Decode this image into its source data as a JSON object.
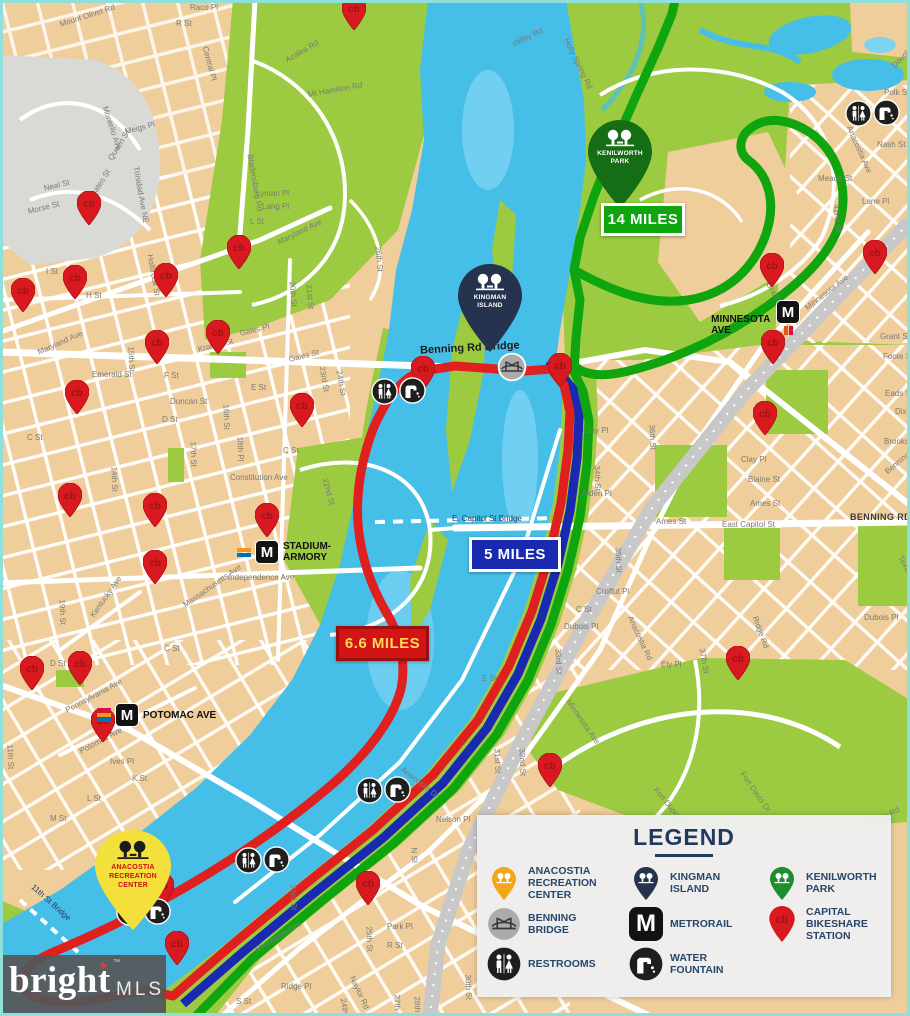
{
  "map": {
    "mile_markers": [
      {
        "id": "green",
        "text": "14 MILES",
        "x": 601,
        "y": 203,
        "w": 78,
        "h": 27,
        "bg": "#0FA50F",
        "border": "#FFFFFF",
        "color": "#FFFFFF"
      },
      {
        "id": "blue",
        "text": "5 MILES",
        "x": 469,
        "y": 537,
        "w": 86,
        "h": 29,
        "bg": "#1A2AB0",
        "border": "#FFFFFF",
        "color": "#FFFFFF"
      },
      {
        "id": "red",
        "text": "6.6 MILES",
        "x": 336,
        "y": 626,
        "w": 87,
        "h": 29,
        "bg": "#D31414",
        "border": "#9C0F0F",
        "color": "#FFD957"
      }
    ],
    "bridge_labels": [
      {
        "text": "Benning Rd Bridge",
        "x": 420,
        "y": 342,
        "r": -3,
        "small": false
      },
      {
        "text": "E. Capitol St Bridge",
        "x": 452,
        "y": 514,
        "r": 0,
        "small": true
      },
      {
        "text": "11th St Bridge",
        "x": 26,
        "y": 898,
        "r": 42,
        "small": true
      }
    ],
    "landmark_pins": [
      {
        "id": "kenilworth",
        "lines": "KENILWORTH\nPARK",
        "x": 620,
        "y": 208,
        "color": "#156E15",
        "tree_color": "#FFFFFF",
        "text_color": "#FFFFFF"
      },
      {
        "id": "kingman",
        "lines": "KINGMAN\nISLAND",
        "x": 490,
        "y": 352,
        "color": "#26334F",
        "tree_color": "#FFFFFF",
        "text_color": "#FFFFFF"
      },
      {
        "id": "recreation",
        "lines": "ANACOSTIA\nRECREATION\nCENTER",
        "x": 133,
        "y": 930,
        "color": "#F4E03A",
        "tree_color": "#1B1B1B",
        "text_color": "#CC1111"
      }
    ],
    "metro_logo": "M",
    "metro_stations": [
      {
        "name": "MINNESOTA AVE",
        "x": 787,
        "y": 324,
        "side": "vert",
        "stripes": [
          "#E6541F",
          "#D31245"
        ]
      },
      {
        "name": "STADIUM-\nARMORY",
        "x": 264,
        "y": 551,
        "side": "right",
        "stripes": [
          "#F7941D",
          "#0072BC"
        ]
      },
      {
        "name": "POTOMAC AVE",
        "x": 124,
        "y": 714,
        "side": "right",
        "stripes": [
          "#D31245",
          "#F7941D",
          "#0072BC"
        ]
      }
    ],
    "bikeshare_pins": [
      {
        "x": 354,
        "y": 13
      },
      {
        "x": 89,
        "y": 208
      },
      {
        "x": 239,
        "y": 252
      },
      {
        "x": 166,
        "y": 280
      },
      {
        "x": 75,
        "y": 282
      },
      {
        "x": 23,
        "y": 295
      },
      {
        "x": 157,
        "y": 347
      },
      {
        "x": 218,
        "y": 337
      },
      {
        "x": 77,
        "y": 397
      },
      {
        "x": 302,
        "y": 410
      },
      {
        "x": 423,
        "y": 373
      },
      {
        "x": 772,
        "y": 270
      },
      {
        "x": 875,
        "y": 257
      },
      {
        "x": 773,
        "y": 347
      },
      {
        "x": 765,
        "y": 418
      },
      {
        "x": 560,
        "y": 370
      },
      {
        "x": 70,
        "y": 500
      },
      {
        "x": 155,
        "y": 510
      },
      {
        "x": 267,
        "y": 520
      },
      {
        "x": 155,
        "y": 567
      },
      {
        "x": 32,
        "y": 673
      },
      {
        "x": 80,
        "y": 668
      },
      {
        "x": 103,
        "y": 725
      },
      {
        "x": 162,
        "y": 890
      },
      {
        "x": 177,
        "y": 948
      },
      {
        "x": 368,
        "y": 888
      },
      {
        "x": 738,
        "y": 663
      },
      {
        "x": 550,
        "y": 770
      }
    ],
    "amenity_pairs": [
      {
        "x": 398,
        "y": 391
      },
      {
        "x": 872,
        "y": 113
      },
      {
        "x": 383,
        "y": 790
      },
      {
        "x": 262,
        "y": 860
      },
      {
        "x": 143,
        "y": 912
      }
    ],
    "bridge_icons": [
      {
        "x": 512,
        "y": 367
      }
    ],
    "street_labels": [
      {
        "t": "Mount Olivet Rd",
        "x": 60,
        "y": 20,
        "r": -18
      },
      {
        "t": "Central Pl",
        "x": 205,
        "y": 42,
        "r": 75
      },
      {
        "t": "Raco Pl",
        "x": 190,
        "y": 3,
        "r": 0
      },
      {
        "t": "R St",
        "x": 176,
        "y": 19,
        "r": 0
      },
      {
        "t": "Bladensburg Rd",
        "x": 250,
        "y": 150,
        "r": 80
      },
      {
        "t": "Azalea Rd",
        "x": 286,
        "y": 56,
        "r": -30
      },
      {
        "t": "Mt Hamilton Rd",
        "x": 308,
        "y": 90,
        "r": -10
      },
      {
        "t": "Valley Rd",
        "x": 512,
        "y": 40,
        "r": -26
      },
      {
        "t": "Holly Spring Rd",
        "x": 566,
        "y": 34,
        "r": 64
      },
      {
        "t": "Douglas St",
        "x": 893,
        "y": 62,
        "r": -45
      },
      {
        "t": "Polk St",
        "x": 884,
        "y": 88,
        "r": 0
      },
      {
        "t": "Anacostia Ave",
        "x": 849,
        "y": 122,
        "r": 66
      },
      {
        "t": "Nash St",
        "x": 877,
        "y": 140,
        "r": 0
      },
      {
        "t": "Meade St",
        "x": 818,
        "y": 174,
        "r": 0
      },
      {
        "t": "Lane Pl",
        "x": 862,
        "y": 197,
        "r": 0
      },
      {
        "t": "42nd St",
        "x": 836,
        "y": 200,
        "r": 85
      },
      {
        "t": "Montello Ave",
        "x": 105,
        "y": 102,
        "r": 72
      },
      {
        "t": "Meigs Pl",
        "x": 125,
        "y": 127,
        "r": -14
      },
      {
        "t": "Queen St",
        "x": 110,
        "y": 155,
        "r": -58
      },
      {
        "t": "Neal St",
        "x": 44,
        "y": 184,
        "r": -14
      },
      {
        "t": "Morse St",
        "x": 28,
        "y": 207,
        "r": -14
      },
      {
        "t": "Oates St",
        "x": 92,
        "y": 192,
        "r": -58
      },
      {
        "t": "Trinidad Ave NE",
        "x": 136,
        "y": 162,
        "r": 80
      },
      {
        "t": "Lyman Pl",
        "x": 256,
        "y": 189,
        "r": 0
      },
      {
        "t": "Lang Pl",
        "x": 262,
        "y": 202,
        "r": 0
      },
      {
        "t": "L St",
        "x": 250,
        "y": 217,
        "r": 0
      },
      {
        "t": "Maryland Ave",
        "x": 278,
        "y": 238,
        "r": -26
      },
      {
        "t": "Holbrook St",
        "x": 150,
        "y": 250,
        "r": 80
      },
      {
        "t": "20th St",
        "x": 292,
        "y": 277,
        "r": 85
      },
      {
        "t": "21st St",
        "x": 309,
        "y": 280,
        "r": 85
      },
      {
        "t": "26th St",
        "x": 378,
        "y": 242,
        "r": 85
      },
      {
        "t": "H St",
        "x": 86,
        "y": 291,
        "r": 0
      },
      {
        "t": "I St",
        "x": 46,
        "y": 267,
        "r": 0
      },
      {
        "t": "Maryland Ave",
        "x": 38,
        "y": 348,
        "r": -24
      },
      {
        "t": "Emerald St",
        "x": 92,
        "y": 370,
        "r": 0
      },
      {
        "t": "F St",
        "x": 164,
        "y": 371,
        "r": 0
      },
      {
        "t": "Kramer St",
        "x": 198,
        "y": 345,
        "r": -14
      },
      {
        "t": "Gales Pl",
        "x": 240,
        "y": 329,
        "r": -14
      },
      {
        "t": "Gales St",
        "x": 289,
        "y": 355,
        "r": -14
      },
      {
        "t": "E St",
        "x": 251,
        "y": 383,
        "r": 0
      },
      {
        "t": "Duncan St",
        "x": 170,
        "y": 397,
        "r": 0
      },
      {
        "t": "D St",
        "x": 162,
        "y": 415,
        "r": 0
      },
      {
        "t": "C St",
        "x": 27,
        "y": 433,
        "r": 0
      },
      {
        "t": "C St",
        "x": 283,
        "y": 446,
        "r": 0
      },
      {
        "t": "15th St",
        "x": 131,
        "y": 342,
        "r": 88
      },
      {
        "t": "14th St",
        "x": 114,
        "y": 462,
        "r": 88
      },
      {
        "t": "16th St",
        "x": 226,
        "y": 400,
        "r": 88
      },
      {
        "t": "17th St",
        "x": 193,
        "y": 437,
        "r": 88
      },
      {
        "t": "18th Pl",
        "x": 240,
        "y": 432,
        "r": 88
      },
      {
        "t": "23rd St",
        "x": 322,
        "y": 362,
        "r": 80
      },
      {
        "t": "24th St",
        "x": 339,
        "y": 366,
        "r": 80
      },
      {
        "t": "Constitution Ave",
        "x": 230,
        "y": 473,
        "r": 0
      },
      {
        "t": "22nd St",
        "x": 325,
        "y": 474,
        "r": 75
      },
      {
        "t": "Independence Ave",
        "x": 228,
        "y": 573,
        "r": 0
      },
      {
        "t": "Massachusetts Ave",
        "x": 184,
        "y": 601,
        "r": -35
      },
      {
        "t": "Kentucky Ave",
        "x": 92,
        "y": 612,
        "r": -55
      },
      {
        "t": "19th St",
        "x": 62,
        "y": 595,
        "r": 88
      },
      {
        "t": "C St",
        "x": 164,
        "y": 644,
        "r": 0
      },
      {
        "t": "D St",
        "x": 50,
        "y": 659,
        "r": 0
      },
      {
        "t": "Pennsylvania Ave",
        "x": 66,
        "y": 706,
        "r": -28
      },
      {
        "t": "Potomac Ave",
        "x": 80,
        "y": 747,
        "r": -28
      },
      {
        "t": "Ives Pl",
        "x": 110,
        "y": 757,
        "r": 0
      },
      {
        "t": "K St",
        "x": 132,
        "y": 774,
        "r": 0
      },
      {
        "t": "L St",
        "x": 87,
        "y": 794,
        "r": 0
      },
      {
        "t": "M St",
        "x": 50,
        "y": 814,
        "r": 0
      },
      {
        "t": "11th St",
        "x": 10,
        "y": 740,
        "r": 88
      },
      {
        "t": "Anacostia Dr",
        "x": 402,
        "y": 764,
        "r": 38
      },
      {
        "t": "Nelson Pl",
        "x": 436,
        "y": 815,
        "r": 0
      },
      {
        "t": "N St",
        "x": 414,
        "y": 843,
        "r": 88
      },
      {
        "t": "Clay Pl",
        "x": 583,
        "y": 426,
        "r": 0
      },
      {
        "t": "34th St",
        "x": 597,
        "y": 461,
        "r": 88
      },
      {
        "t": "Alden Pl",
        "x": 582,
        "y": 489,
        "r": 0
      },
      {
        "t": "Ames St",
        "x": 656,
        "y": 517,
        "r": 0
      },
      {
        "t": "35th St",
        "x": 618,
        "y": 543,
        "r": 88
      },
      {
        "t": "A St",
        "x": 542,
        "y": 565,
        "r": 0
      },
      {
        "t": "Croffut Pl",
        "x": 596,
        "y": 587,
        "r": 0
      },
      {
        "t": "C St",
        "x": 576,
        "y": 605,
        "r": 0
      },
      {
        "t": "Dubois Pl",
        "x": 564,
        "y": 622,
        "r": 0
      },
      {
        "t": "33rd St",
        "x": 558,
        "y": 644,
        "r": 88
      },
      {
        "t": "36th St",
        "x": 652,
        "y": 420,
        "r": 88
      },
      {
        "t": "East Capitol St",
        "x": 722,
        "y": 520,
        "r": 0
      },
      {
        "t": "Grant St",
        "x": 880,
        "y": 332,
        "r": 0
      },
      {
        "t": "Foote St",
        "x": 883,
        "y": 352,
        "r": 0
      },
      {
        "t": "Eads St",
        "x": 885,
        "y": 389,
        "r": 0
      },
      {
        "t": "Dix St",
        "x": 895,
        "y": 407,
        "r": 0
      },
      {
        "t": "Brooks St",
        "x": 884,
        "y": 437,
        "r": 0
      },
      {
        "t": "Benning Rd",
        "x": 886,
        "y": 468,
        "r": -40
      },
      {
        "t": "Clay Pl",
        "x": 741,
        "y": 455,
        "r": 0
      },
      {
        "t": "Blaine St",
        "x": 748,
        "y": 475,
        "r": 0
      },
      {
        "t": "Ames St",
        "x": 750,
        "y": 499,
        "r": 0
      },
      {
        "t": "BENNING RD",
        "x": 850,
        "y": 512,
        "r": 0,
        "b": true
      },
      {
        "t": "Texas Ave",
        "x": 900,
        "y": 552,
        "r": 60
      },
      {
        "t": "Dubois Pl",
        "x": 864,
        "y": 613,
        "r": 0
      },
      {
        "t": "Ridge Rd",
        "x": 755,
        "y": 612,
        "r": 70
      },
      {
        "t": "Anacostia Rd",
        "x": 630,
        "y": 612,
        "r": 65
      },
      {
        "t": "37th St",
        "x": 702,
        "y": 644,
        "r": 80
      },
      {
        "t": "Ely Pl",
        "x": 661,
        "y": 660,
        "r": 0
      },
      {
        "t": "E St",
        "x": 482,
        "y": 674,
        "r": 0
      },
      {
        "t": "Minnesota Ave",
        "x": 568,
        "y": 696,
        "r": 55
      },
      {
        "t": "31st St",
        "x": 497,
        "y": 744,
        "r": 88
      },
      {
        "t": "32nd St",
        "x": 522,
        "y": 744,
        "r": 88
      },
      {
        "t": "Fort Dupont Dr",
        "x": 655,
        "y": 784,
        "r": 50
      },
      {
        "t": "Fort Davis Dr",
        "x": 742,
        "y": 768,
        "r": 55
      },
      {
        "t": "Bridge Rd",
        "x": 868,
        "y": 822,
        "r": -30
      },
      {
        "t": "Grant Pl",
        "x": 768,
        "y": 278,
        "r": 60
      },
      {
        "t": "Minnesota Ave",
        "x": 806,
        "y": 304,
        "r": -38
      },
      {
        "t": "23rd St",
        "x": 293,
        "y": 880,
        "r": 88
      },
      {
        "t": "25th St",
        "x": 369,
        "y": 922,
        "r": 88
      },
      {
        "t": "Park Pl",
        "x": 387,
        "y": 922,
        "r": 0
      },
      {
        "t": "R St",
        "x": 387,
        "y": 941,
        "r": 0
      },
      {
        "t": "R St",
        "x": 558,
        "y": 946,
        "r": 0
      },
      {
        "t": "Minnesota Ave",
        "x": 256,
        "y": 946,
        "r": -32
      },
      {
        "t": "Naylor Rd",
        "x": 352,
        "y": 972,
        "r": 65
      },
      {
        "t": "Ridge Pl",
        "x": 281,
        "y": 982,
        "r": 0
      },
      {
        "t": "S St",
        "x": 236,
        "y": 997,
        "r": 0
      },
      {
        "t": "24th Pl",
        "x": 343,
        "y": 994,
        "r": 80
      },
      {
        "t": "27th St",
        "x": 397,
        "y": 990,
        "r": 88
      },
      {
        "t": "28th St",
        "x": 417,
        "y": 992,
        "r": 88
      },
      {
        "t": "30th St",
        "x": 468,
        "y": 970,
        "r": 88
      }
    ]
  },
  "legend": {
    "title": "LEGEND",
    "items": [
      {
        "icon": "recreation-pin",
        "label": "ANACOSTIA RECREATION CENTER"
      },
      {
        "icon": "kingman-pin",
        "label": "KINGMAN ISLAND"
      },
      {
        "icon": "kenilworth-pin",
        "label": "KENILWORTH PARK"
      },
      {
        "icon": "benning-bridge",
        "label": "BENNING BRIDGE"
      },
      {
        "icon": "metrorail",
        "label": "METRORAIL"
      },
      {
        "icon": "bikeshare-pin",
        "label": "CAPITAL BIKESHARE STATION"
      },
      {
        "icon": "restrooms",
        "label": "RESTROOMS"
      },
      {
        "icon": "water-fountain",
        "label": "WATER FOUNTAIN"
      }
    ],
    "icon_colors": {
      "recreation": "#F2A71B",
      "kingman": "#26334F",
      "kenilworth": "#1E8E2E",
      "bikeshare": "#D8191F"
    }
  },
  "watermark": {
    "brand": "bright",
    "star": "✦",
    "tm": "™",
    "suffix": "MLS"
  },
  "colors": {
    "route_red": "#E01F1F",
    "route_blue": "#1A2AB0",
    "route_green": "#0FA50F",
    "water": "#45BEE8",
    "park": "#9CCB42",
    "land": "#F0CE9C",
    "railroad": "#C8C8C8",
    "pin_red": "#D8191F"
  }
}
